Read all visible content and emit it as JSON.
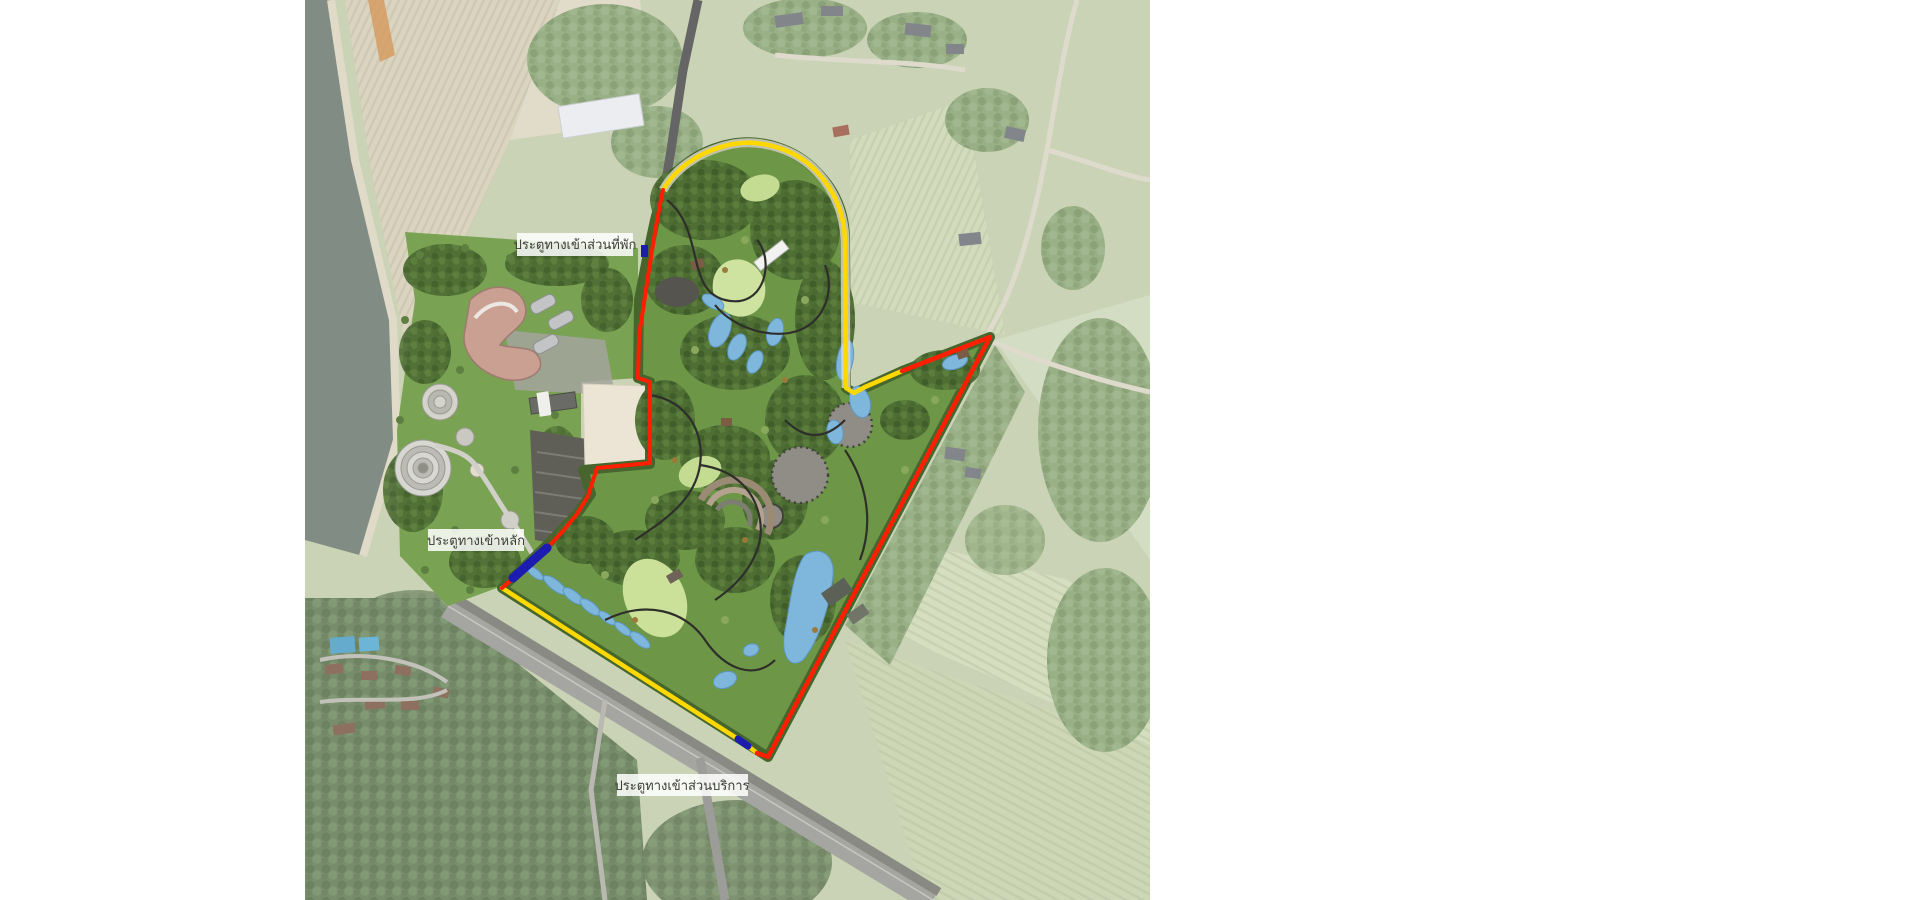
{
  "map_labels": {
    "residence_gate": "ประตูทางเข้าส่วนที่พัก",
    "main_gate": "ประตูทางเข้าหลัก",
    "service_gate": "ประตูทางเข้าส่วนบริการ"
  },
  "legend": {
    "items": [
      {
        "label": "รั้วเดิม",
        "color": "#ffd800"
      },
      {
        "label": "รั้วสร้างใหม่เพิ่มเติม",
        "color": "#ff1e00"
      },
      {
        "label": "ประตูทางเข้า",
        "color": "#1c1cb0"
      }
    ]
  },
  "scale_bar": {
    "ticks": [
      "๐",
      "๕๐",
      "๑๐๐",
      "๒๐๐",
      "๓๐๐"
    ]
  },
  "colors": {
    "fence_existing": "#ffd800",
    "fence_new": "#ff1e00",
    "gate": "#1c1cb0",
    "water": "#6f7b72",
    "park_green": "#6d9747",
    "pond_blue": "#7fb7dc"
  }
}
